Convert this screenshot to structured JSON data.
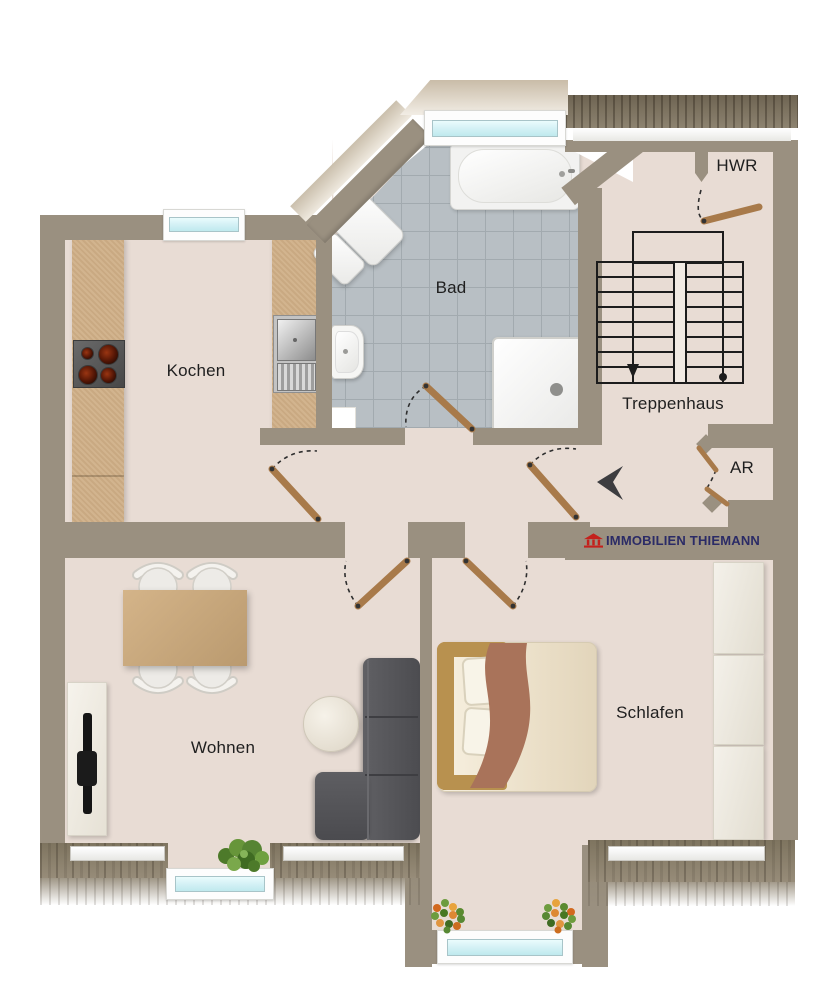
{
  "plan": {
    "type": "apartment-floor-plan",
    "rooms": {
      "bad": {
        "label": "Bad"
      },
      "kochen": {
        "label": "Kochen"
      },
      "hwr": {
        "label": "HWR"
      },
      "treppenhaus": {
        "label": "Treppenhaus"
      },
      "ar": {
        "label": "AR"
      },
      "wohnen": {
        "label": "Wohnen"
      },
      "schlafen": {
        "label": "Schlafen"
      }
    },
    "stairs": {
      "flights": 2,
      "steps_per_flight": 8,
      "direction_arrow": "down"
    },
    "branding": {
      "company": "IMMOBILIEN THIEMANN",
      "icon": "house-icon"
    },
    "colors": {
      "wall": "#9a9080",
      "floor": "#e8dcd4",
      "tile": "#b8bfc4",
      "tile-line": "#a2aaaf",
      "counter": "#cfae86",
      "door": "#a87a4a",
      "glass": "#d6f2f6",
      "sofa": "#56565a",
      "table": "#c9a87c",
      "blanket": "#a9735a",
      "gold": "#b8914f",
      "logo-text": "#2b2b66",
      "logo-red": "#c4211c",
      "stair-line": "#1c1c1c"
    }
  }
}
